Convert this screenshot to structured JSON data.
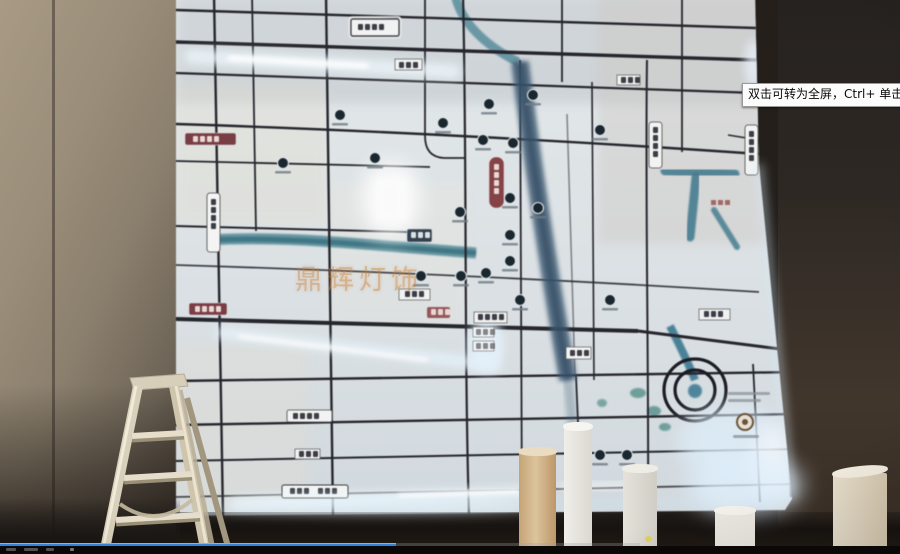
{
  "video": {
    "tooltip": "双击可转为全屏，Ctrl+ 单击可转为",
    "progress_percent": 44
  },
  "scene": {
    "watermark_text": "鼎辉灯饰"
  },
  "colors": {
    "progress_blue": "#2f82dd",
    "led_glow": "#eaf7ff",
    "river_teal": "#4d8a99",
    "road_dark": "#23232b",
    "wall_tan": "#8f8478"
  }
}
